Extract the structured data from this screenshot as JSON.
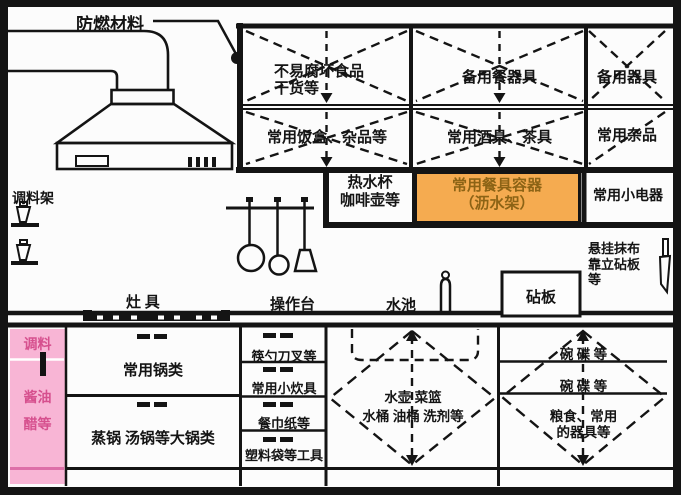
{
  "palette": {
    "line": "#141414",
    "orange_bg": "#f5ab50",
    "orange_text": "#8c6315",
    "pink_bg": "#f8b5d5",
    "pink_text": "#d6508e"
  },
  "callout": {
    "fire_material": "防燃材料"
  },
  "upper_cabinets": {
    "cells": [
      {
        "name": "durable-food",
        "lines": [
          "不易腐坏食品",
          "干货等"
        ]
      },
      {
        "name": "spare-tableware",
        "lines": [
          "备用餐器具"
        ]
      },
      {
        "name": "spare-utensils",
        "lines": [
          "备用器具"
        ]
      },
      {
        "name": "lunchboxes",
        "lines": [
          "常用饭盒、杂品等"
        ]
      },
      {
        "name": "drinkware",
        "lines": [
          "常用酒具、茶具"
        ]
      },
      {
        "name": "sundries",
        "lines": [
          "常用杂品"
        ]
      }
    ]
  },
  "mid_cells": {
    "hot_water": {
      "lines": [
        "热水杯",
        "咖啡壶等"
      ]
    },
    "drain_rack": {
      "lines": [
        "常用餐具容器",
        "（沥水架）"
      ]
    },
    "small_appliances": {
      "lines": [
        "常用小电器"
      ]
    }
  },
  "wall": {
    "spice_rack": "调料架",
    "stove": "灶 具",
    "worktop": "操作台",
    "sink": "水池",
    "cutting_board": "砧板",
    "hanging_note_lines": [
      "悬挂抹布",
      "靠立砧板",
      "等"
    ]
  },
  "base_cabinets": {
    "condiment_lines": [
      "调料",
      "酱油",
      "醋等"
    ],
    "pots": "常用锅类",
    "large_pots": "蒸锅 汤锅等大锅类",
    "drawers": [
      "筷勺刀叉等",
      "常用小炊具",
      "餐巾纸等",
      "塑料袋等工具"
    ],
    "under_sink_lines": [
      "水壶 菜篮",
      "水桶 油桶 洗剂等"
    ],
    "right_cells": [
      {
        "lines": [
          "碗 碟 等"
        ]
      },
      {
        "lines": [
          "碗 碟 等"
        ]
      },
      {
        "lines": [
          "粮食、常用",
          "的器具等"
        ]
      }
    ]
  }
}
